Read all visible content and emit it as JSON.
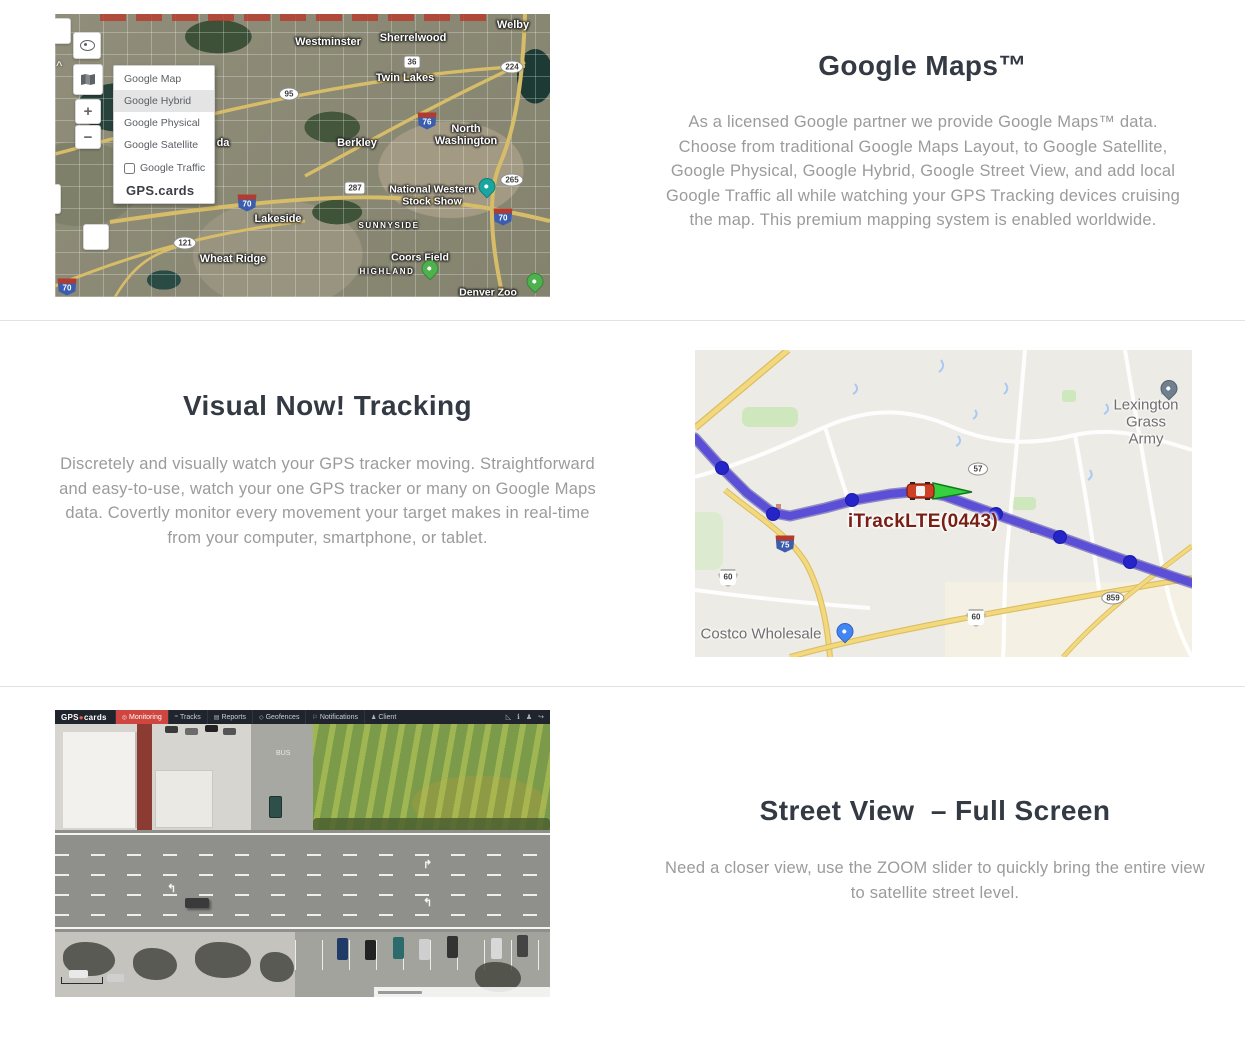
{
  "sections": {
    "google_maps": {
      "title": "Google Maps™",
      "body": "As a licensed Google partner we provide Google Maps™ data. Choose from traditional Google Maps Layout, to Google Satellite, Google Physical, Google Hybrid, Google Street View, and add local Google Traffic all while watching your GPS Tracking devices cruising the map. This premium mapping system is enabled worldwide.",
      "map": {
        "layers_panel": {
          "items": [
            "Google Map",
            "Google Hybrid",
            "Google Physical",
            "Google Satellite"
          ],
          "selected": "Google Hybrid",
          "traffic_label": "Google Traffic",
          "traffic_checked": false,
          "brand": "GPS.cards"
        },
        "controls": {
          "zoom_in": "+",
          "zoom_out": "−"
        },
        "labels": [
          {
            "text": "Westminster",
            "type": "city",
            "x": 273,
            "y": 28
          },
          {
            "text": "Sherrelwood",
            "type": "city",
            "x": 358,
            "y": 24
          },
          {
            "text": "Welby",
            "type": "city",
            "x": 458,
            "y": 11
          },
          {
            "text": "Twin Lakes",
            "type": "city",
            "x": 350,
            "y": 64
          },
          {
            "text": "North\nWashington",
            "type": "city",
            "x": 411,
            "y": 121
          },
          {
            "text": "Berkley",
            "type": "city",
            "x": 302,
            "y": 129
          },
          {
            "text": "da",
            "type": "city",
            "x": 168,
            "y": 129
          },
          {
            "text": "Lakeside",
            "type": "city",
            "x": 223,
            "y": 205
          },
          {
            "text": "SUNNYSIDE",
            "type": "nbhd",
            "x": 334,
            "y": 212
          },
          {
            "text": "National Western\nStock Show",
            "type": "poi",
            "x": 377,
            "y": 182
          },
          {
            "text": "Wheat Ridge",
            "type": "city",
            "x": 178,
            "y": 245
          },
          {
            "text": "Coors Field",
            "type": "poi",
            "x": 365,
            "y": 244
          },
          {
            "text": "HIGHLAND",
            "type": "nbhd",
            "x": 332,
            "y": 258
          },
          {
            "text": "Denver Zoo",
            "type": "poi",
            "x": 433,
            "y": 279
          }
        ],
        "shields": [
          {
            "text": "36",
            "kind": "state",
            "x": 357,
            "y": 48
          },
          {
            "text": "224",
            "kind": "oval",
            "x": 457,
            "y": 53
          },
          {
            "text": "95",
            "kind": "oval",
            "x": 234,
            "y": 80
          },
          {
            "text": "76",
            "kind": "interstate",
            "x": 372,
            "y": 107
          },
          {
            "text": "287",
            "kind": "state",
            "x": 300,
            "y": 174
          },
          {
            "text": "70",
            "kind": "interstate",
            "x": 192,
            "y": 189
          },
          {
            "text": "265",
            "kind": "oval",
            "x": 457,
            "y": 166
          },
          {
            "text": "70",
            "kind": "interstate",
            "x": 448,
            "y": 203
          },
          {
            "text": "121",
            "kind": "oval",
            "x": 130,
            "y": 229
          },
          {
            "text": "70",
            "kind": "interstate",
            "x": 12,
            "y": 273
          }
        ],
        "pins": [
          {
            "kind": "teal",
            "x": 432,
            "y": 181
          },
          {
            "kind": "green",
            "x": 375,
            "y": 263
          },
          {
            "kind": "green",
            "x": 480,
            "y": 276
          }
        ]
      }
    },
    "visual_tracking": {
      "title": "Visual Now! Tracking",
      "body": "Discretely and visually watch your GPS tracker moving. Straightforward and easy-to-use, watch your one GPS tracker or many on Google Maps data. Covertly monitor every movement your target makes in real-time from your computer, smartphone, or tablet.",
      "map": {
        "tracker_label": "iTrackLTE(0443)",
        "tracker_label_pos": {
          "x": 228,
          "y": 172
        },
        "labels": [
          {
            "text": "Lexington\nGrass Army",
            "x": 451,
            "y": 72
          },
          {
            "text": "Costco Wholesale",
            "x": 66,
            "y": 284
          }
        ],
        "pins": [
          {
            "kind": "gray",
            "x": 474,
            "y": 47
          },
          {
            "kind": "blue",
            "x": 150,
            "y": 290
          }
        ],
        "shields": [
          {
            "text": "57",
            "kind": "oval",
            "x": 283,
            "y": 119
          },
          {
            "text": "75",
            "kind": "interstate",
            "x": 90,
            "y": 194
          },
          {
            "text": "60",
            "kind": "us",
            "x": 33,
            "y": 228
          },
          {
            "text": "859",
            "kind": "oval",
            "x": 418,
            "y": 248
          },
          {
            "text": "60",
            "kind": "us",
            "x": 281,
            "y": 268
          }
        ],
        "route": {
          "color": "#5a4fd6",
          "casing": "#443aa8",
          "dot_color": "#2424c8",
          "points": [
            [
              0,
              88
            ],
            [
              27,
              118
            ],
            [
              52,
              143
            ],
            [
              78,
              163
            ],
            [
              95,
              166
            ],
            [
              130,
              158
            ],
            [
              160,
              150
            ],
            [
              195,
              144
            ],
            [
              225,
              141
            ],
            [
              250,
              146
            ],
            [
              300,
              164
            ],
            [
              365,
              187
            ],
            [
              435,
              212
            ],
            [
              497,
              233
            ]
          ],
          "dots": [
            [
              27,
              118
            ],
            [
              78,
              164
            ],
            [
              157,
              150
            ],
            [
              301,
              164
            ],
            [
              365,
              187
            ],
            [
              435,
              212
            ]
          ],
          "car": {
            "x": 225,
            "y": 141
          },
          "arrow_tip": {
            "x": 277,
            "y": 142
          }
        }
      }
    },
    "street_view": {
      "title": "Street View  – Full Screen",
      "body": "Need a closer view, use the ZOOM slider to quickly bring the entire view to satellite street level.",
      "app_toolbar": {
        "brand": "GPS.cards",
        "tabs": [
          {
            "label": "Monitoring",
            "icon": "monitor-icon",
            "active": true
          },
          {
            "label": "Tracks",
            "icon": "tracks-icon",
            "active": false
          },
          {
            "label": "Reports",
            "icon": "report-icon",
            "active": false
          },
          {
            "label": "Geofences",
            "icon": "geofence-icon",
            "active": false
          },
          {
            "label": "Notifications",
            "icon": "notification-icon",
            "active": false
          },
          {
            "label": "Client",
            "icon": "client-icon",
            "active": false
          }
        ],
        "right_icons": [
          "ruler-icon",
          "info-icon",
          "user-icon",
          "logout-icon"
        ]
      }
    }
  }
}
